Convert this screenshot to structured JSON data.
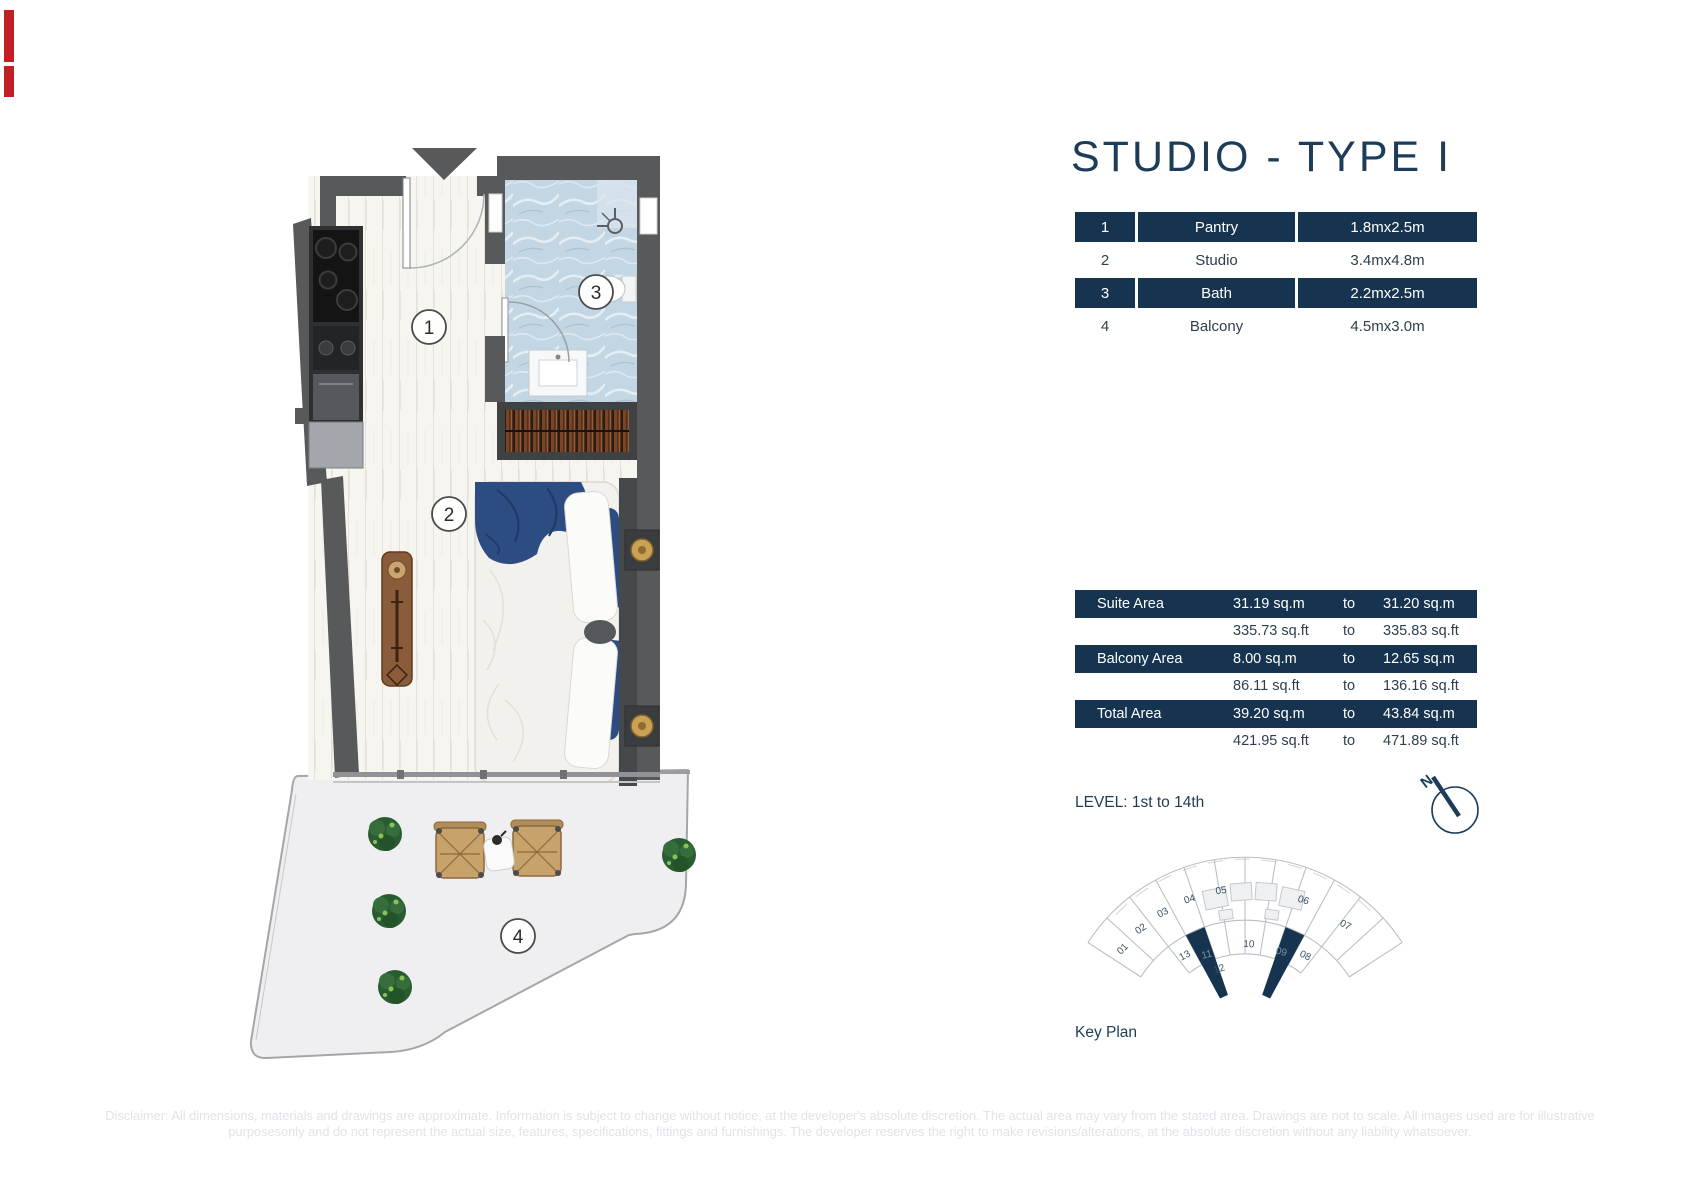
{
  "title": "STUDIO - TYPE I",
  "room_table": {
    "rows": [
      {
        "num": "1",
        "name": "Pantry",
        "dims": "1.8mx2.5m"
      },
      {
        "num": "2",
        "name": "Studio",
        "dims": "3.4mx4.8m"
      },
      {
        "num": "3",
        "name": "Bath",
        "dims": "2.2mx2.5m"
      },
      {
        "num": "4",
        "name": "Balcony",
        "dims": "4.5mx3.0m"
      }
    ]
  },
  "area_table": {
    "rows": [
      {
        "label": "Suite Area",
        "v1": "31.19 sq.m",
        "to": "to",
        "v2": "31.20 sq.m"
      },
      {
        "label": "",
        "v1": "335.73 sq.ft",
        "to": "to",
        "v2": "335.83 sq.ft"
      },
      {
        "label": "Balcony Area",
        "v1": "8.00 sq.m",
        "to": "to",
        "v2": "12.65 sq.m"
      },
      {
        "label": "",
        "v1": "86.11 sq.ft",
        "to": "to",
        "v2": "136.16 sq.ft"
      },
      {
        "label": "Total Area",
        "v1": "39.20 sq.m",
        "to": "to",
        "v2": "43.84 sq.m"
      },
      {
        "label": "",
        "v1": "421.95 sq.ft",
        "to": "to",
        "v2": "471.89 sq.ft"
      }
    ]
  },
  "level_label": "LEVEL: 1st to 14th",
  "compass": {
    "north_label": "N"
  },
  "key_plan": {
    "caption": "Key Plan",
    "units": [
      "01",
      "02",
      "03",
      "04",
      "05",
      "06",
      "07",
      "08",
      "09",
      "10",
      "11",
      "12",
      "13"
    ],
    "highlighted_units": [
      "09",
      "11"
    ]
  },
  "plan": {
    "labels": [
      "1",
      "2",
      "3",
      "4"
    ]
  },
  "disclaimer": {
    "line1": "Disclaimer: All dimensions, materials and drawings are approximate. Information is subject to change without notice, at the developer's absolute discretion. The actual area may vary from the stated area. Drawings are not to scale. All images used are for illustrative",
    "line2": "purposesonly and do not represent the actual size, features, specifications, fittings and furnishings. The developer reserves the right to make revisions/alterations, at the absolute discretion without any liability whatsoever."
  },
  "colors": {
    "accent_navy": "#163450",
    "title_navy": "#1d3c58",
    "wall_gray": "#58595b",
    "bath_blue": "#c3d6e3",
    "bed_blue": "#2c4c82",
    "wood_brown": "#8a5c39",
    "plant_green": "#2a5c31",
    "disclaimer_gray": "#dfe3ec",
    "red_marker": "#c32026"
  }
}
